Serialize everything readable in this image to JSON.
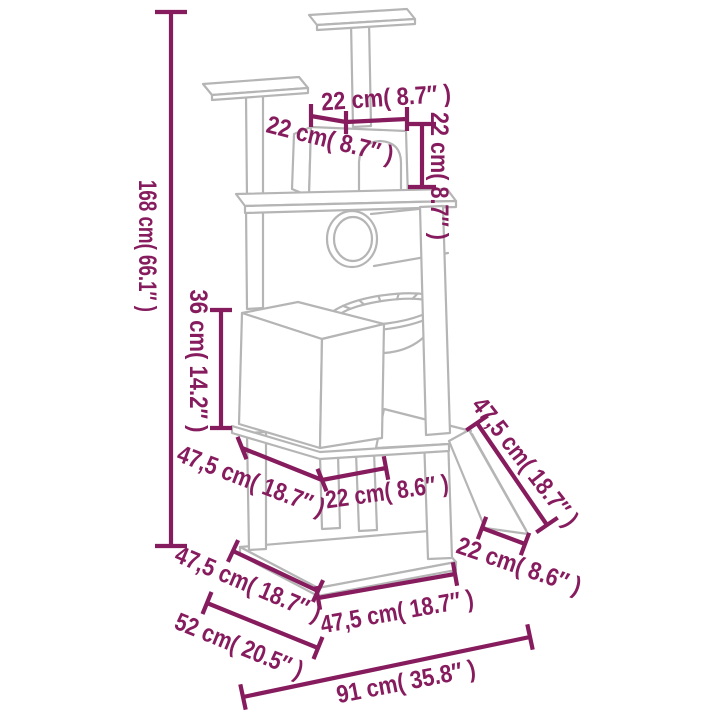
{
  "page": {
    "background": "#ffffff",
    "alt": "Cat tree with scratching posts - line drawing with dimension annotations"
  },
  "colors": {
    "dimension": "#861c5e",
    "structure": "#b5b5b5"
  },
  "dimensions": {
    "total_height": {
      "label": "168 cm( 66.1″ )"
    },
    "top_platform_width": {
      "label": "22 cm( 8.7″ )"
    },
    "top_platform_depth": {
      "label": "22 cm( 8.7″ )"
    },
    "condo_height": {
      "label": "22 cm( 8.7″ )"
    },
    "cube_house_height": {
      "label": "36 cm( 14.2″ )"
    },
    "mid_platform_width": {
      "label": "47,5 cm( 18.7″ )"
    },
    "mid_platform_depth": {
      "label": "22 cm( 8.6″ )"
    },
    "ramp_length": {
      "label": "47,5 cm( 18.7″ )"
    },
    "ramp_bottom_width": {
      "label": "22 cm( 8.6″ )"
    },
    "base_side_depth": {
      "label": "47,5 cm( 18.7″ )"
    },
    "base_diagonal": {
      "label": "52 cm( 20.5″ )"
    },
    "base_front_width": {
      "label": "47,5 cm( 18.7″ )"
    },
    "footprint_width": {
      "label": "91 cm( 35.8″ )"
    }
  }
}
